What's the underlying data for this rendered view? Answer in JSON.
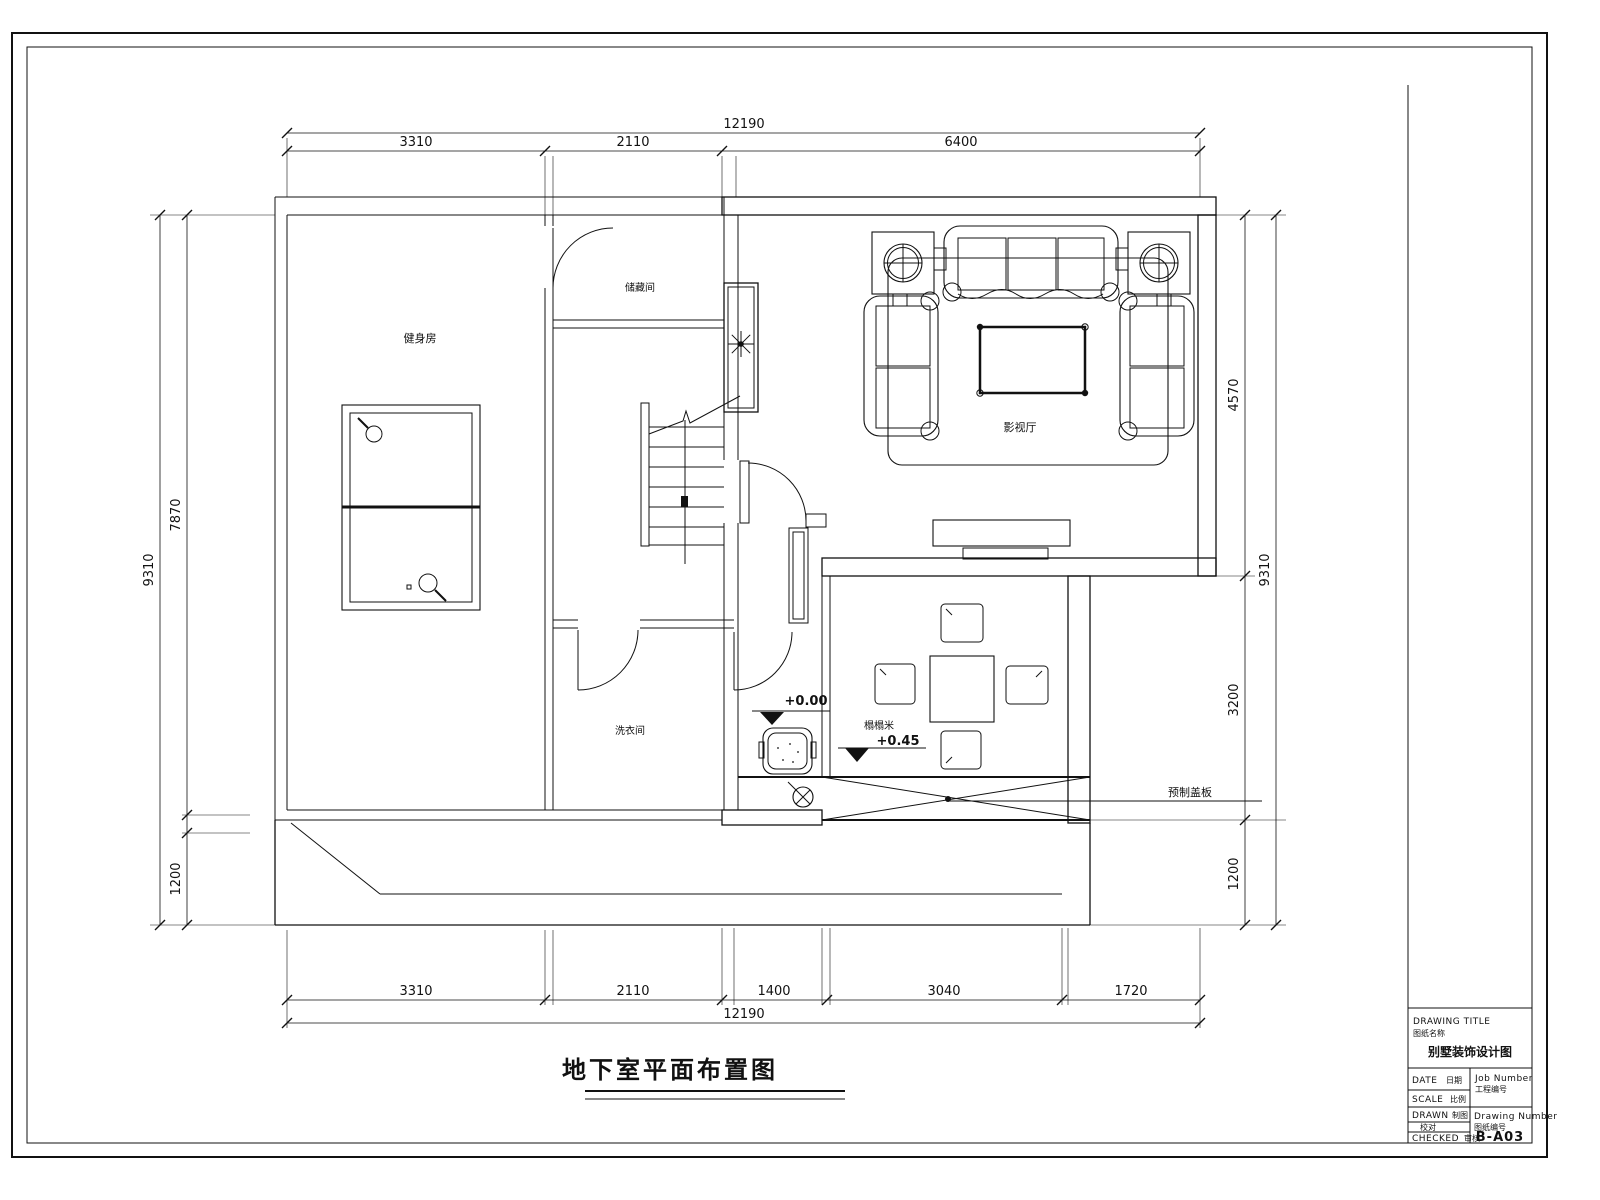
{
  "drawing": {
    "title": "地下室平面布置图",
    "rooms": {
      "gym": "健身房",
      "storage": "储藏间",
      "laundry": "洗衣间",
      "theater": "影视厅",
      "tatami": "榻榻米"
    },
    "levels": {
      "ground": "+0.00",
      "raised": "+0.45"
    },
    "annotations": {
      "cover_note": "预制盖板"
    },
    "dimensions": {
      "top": {
        "overall": "12190",
        "segments": [
          "3310",
          "2110",
          "6400"
        ]
      },
      "bottom": {
        "overall": "12190",
        "segments": [
          "3310",
          "2110",
          "1400",
          "3040",
          "1720"
        ]
      },
      "left": {
        "overall": "9310",
        "segments": [
          "7870",
          "1200"
        ]
      },
      "right": {
        "overall": "9310",
        "segments": [
          "4570",
          "3200",
          "1200"
        ]
      }
    }
  },
  "titleblock": {
    "drawing_title_label": "DRAWING TITLE",
    "drawing_title_label_cn": "图纸名称",
    "project_name": "别墅装饰设计图",
    "rows": {
      "date": "DATE",
      "date_cn": "日期",
      "scale": "SCALE",
      "scale_cn": "比例",
      "drawn": "DRAWN",
      "drawn_cn": "制图",
      "check_cn": "校对",
      "checked": "CHECKED",
      "checked_cn": "审核"
    },
    "job_number_label": "Job Number",
    "job_number_label_cn": "工程编号",
    "drawing_number_label": "Drawing Number",
    "drawing_number_label_cn": "图纸编号",
    "drawing_number": "B-A03"
  }
}
